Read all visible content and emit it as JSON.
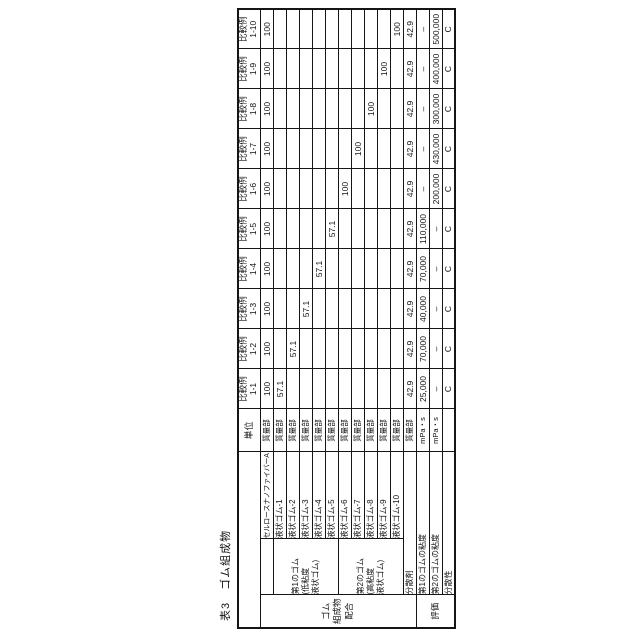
{
  "title": "表3　ゴム組成物",
  "colors": {
    "background": "#ffffff",
    "line": "#151515",
    "text": "#121212"
  },
  "table": {
    "unit_header": "単位",
    "columns": [
      {
        "line1": "比較例",
        "line2": "1-1"
      },
      {
        "line1": "比較例",
        "line2": "1-2"
      },
      {
        "line1": "比較例",
        "line2": "1-3"
      },
      {
        "line1": "比較例",
        "line2": "1-4"
      },
      {
        "line1": "比較例",
        "line2": "1-5"
      },
      {
        "line1": "比較例",
        "line2": "1-6"
      },
      {
        "line1": "比較例",
        "line2": "1-7"
      },
      {
        "line1": "比較例",
        "line2": "1-8"
      },
      {
        "line1": "比較例",
        "line2": "1-9"
      },
      {
        "line1": "比較例",
        "line2": "1-10"
      }
    ],
    "outer_groups": [
      {
        "label": "ゴム\n組成物\n配合"
      },
      {
        "label": "評価"
      }
    ],
    "rubber_groups": [
      {
        "label": "第1のゴム\n(低粘度\n液状ゴム)"
      },
      {
        "label": "第2のゴム\n(高粘度\n液状ゴム)"
      }
    ],
    "rows": [
      {
        "name": "セルロースナノファイバーA",
        "unit": "質量部",
        "values": [
          "100",
          "100",
          "100",
          "100",
          "100",
          "100",
          "100",
          "100",
          "100",
          "100"
        ]
      },
      {
        "name": "液状ゴム-1",
        "unit": "質量部",
        "values": [
          "57.1",
          "",
          "",
          "",
          "",
          "",
          "",
          "",
          "",
          ""
        ]
      },
      {
        "name": "液状ゴム-2",
        "unit": "質量部",
        "values": [
          "",
          "57.1",
          "",
          "",
          "",
          "",
          "",
          "",
          "",
          ""
        ]
      },
      {
        "name": "液状ゴム-3",
        "unit": "質量部",
        "values": [
          "",
          "",
          "57.1",
          "",
          "",
          "",
          "",
          "",
          "",
          ""
        ]
      },
      {
        "name": "液状ゴム-4",
        "unit": "質量部",
        "values": [
          "",
          "",
          "",
          "57.1",
          "",
          "",
          "",
          "",
          "",
          ""
        ]
      },
      {
        "name": "液状ゴム-5",
        "unit": "質量部",
        "values": [
          "",
          "",
          "",
          "",
          "57.1",
          "",
          "",
          "",
          "",
          ""
        ]
      },
      {
        "name": "液状ゴム-6",
        "unit": "質量部",
        "values": [
          "",
          "",
          "",
          "",
          "",
          "100",
          "",
          "",
          "",
          ""
        ]
      },
      {
        "name": "液状ゴム-7",
        "unit": "質量部",
        "values": [
          "",
          "",
          "",
          "",
          "",
          "",
          "100",
          "",
          "",
          ""
        ]
      },
      {
        "name": "液状ゴム-8",
        "unit": "質量部",
        "values": [
          "",
          "",
          "",
          "",
          "",
          "",
          "",
          "100",
          "",
          ""
        ]
      },
      {
        "name": "液状ゴム-9",
        "unit": "質量部",
        "values": [
          "",
          "",
          "",
          "",
          "",
          "",
          "",
          "",
          "100",
          ""
        ]
      },
      {
        "name": "液状ゴム-10",
        "unit": "質量部",
        "values": [
          "",
          "",
          "",
          "",
          "",
          "",
          "",
          "",
          "",
          "100"
        ]
      },
      {
        "name": "分散剤",
        "unit": "質量部",
        "values": [
          "42.9",
          "42.9",
          "42.9",
          "42.9",
          "42.9",
          "42.9",
          "42.9",
          "42.9",
          "42.9",
          "42.9"
        ]
      },
      {
        "name": "第1のゴムの粘度",
        "unit": "mPa・s",
        "values": [
          "25,000",
          "70,000",
          "40,000",
          "70,000",
          "110,000",
          "–",
          "–",
          "–",
          "–",
          "–"
        ]
      },
      {
        "name": "第2のゴムの粘度",
        "unit": "mPa・s",
        "values": [
          "–",
          "–",
          "–",
          "–",
          "–",
          "200,000",
          "430,000",
          "300,000",
          "400,000",
          "500,000"
        ]
      },
      {
        "name": "分散性",
        "unit": "",
        "values": [
          "C",
          "C",
          "C",
          "C",
          "C",
          "C",
          "C",
          "C",
          "C",
          "C"
        ]
      }
    ]
  }
}
